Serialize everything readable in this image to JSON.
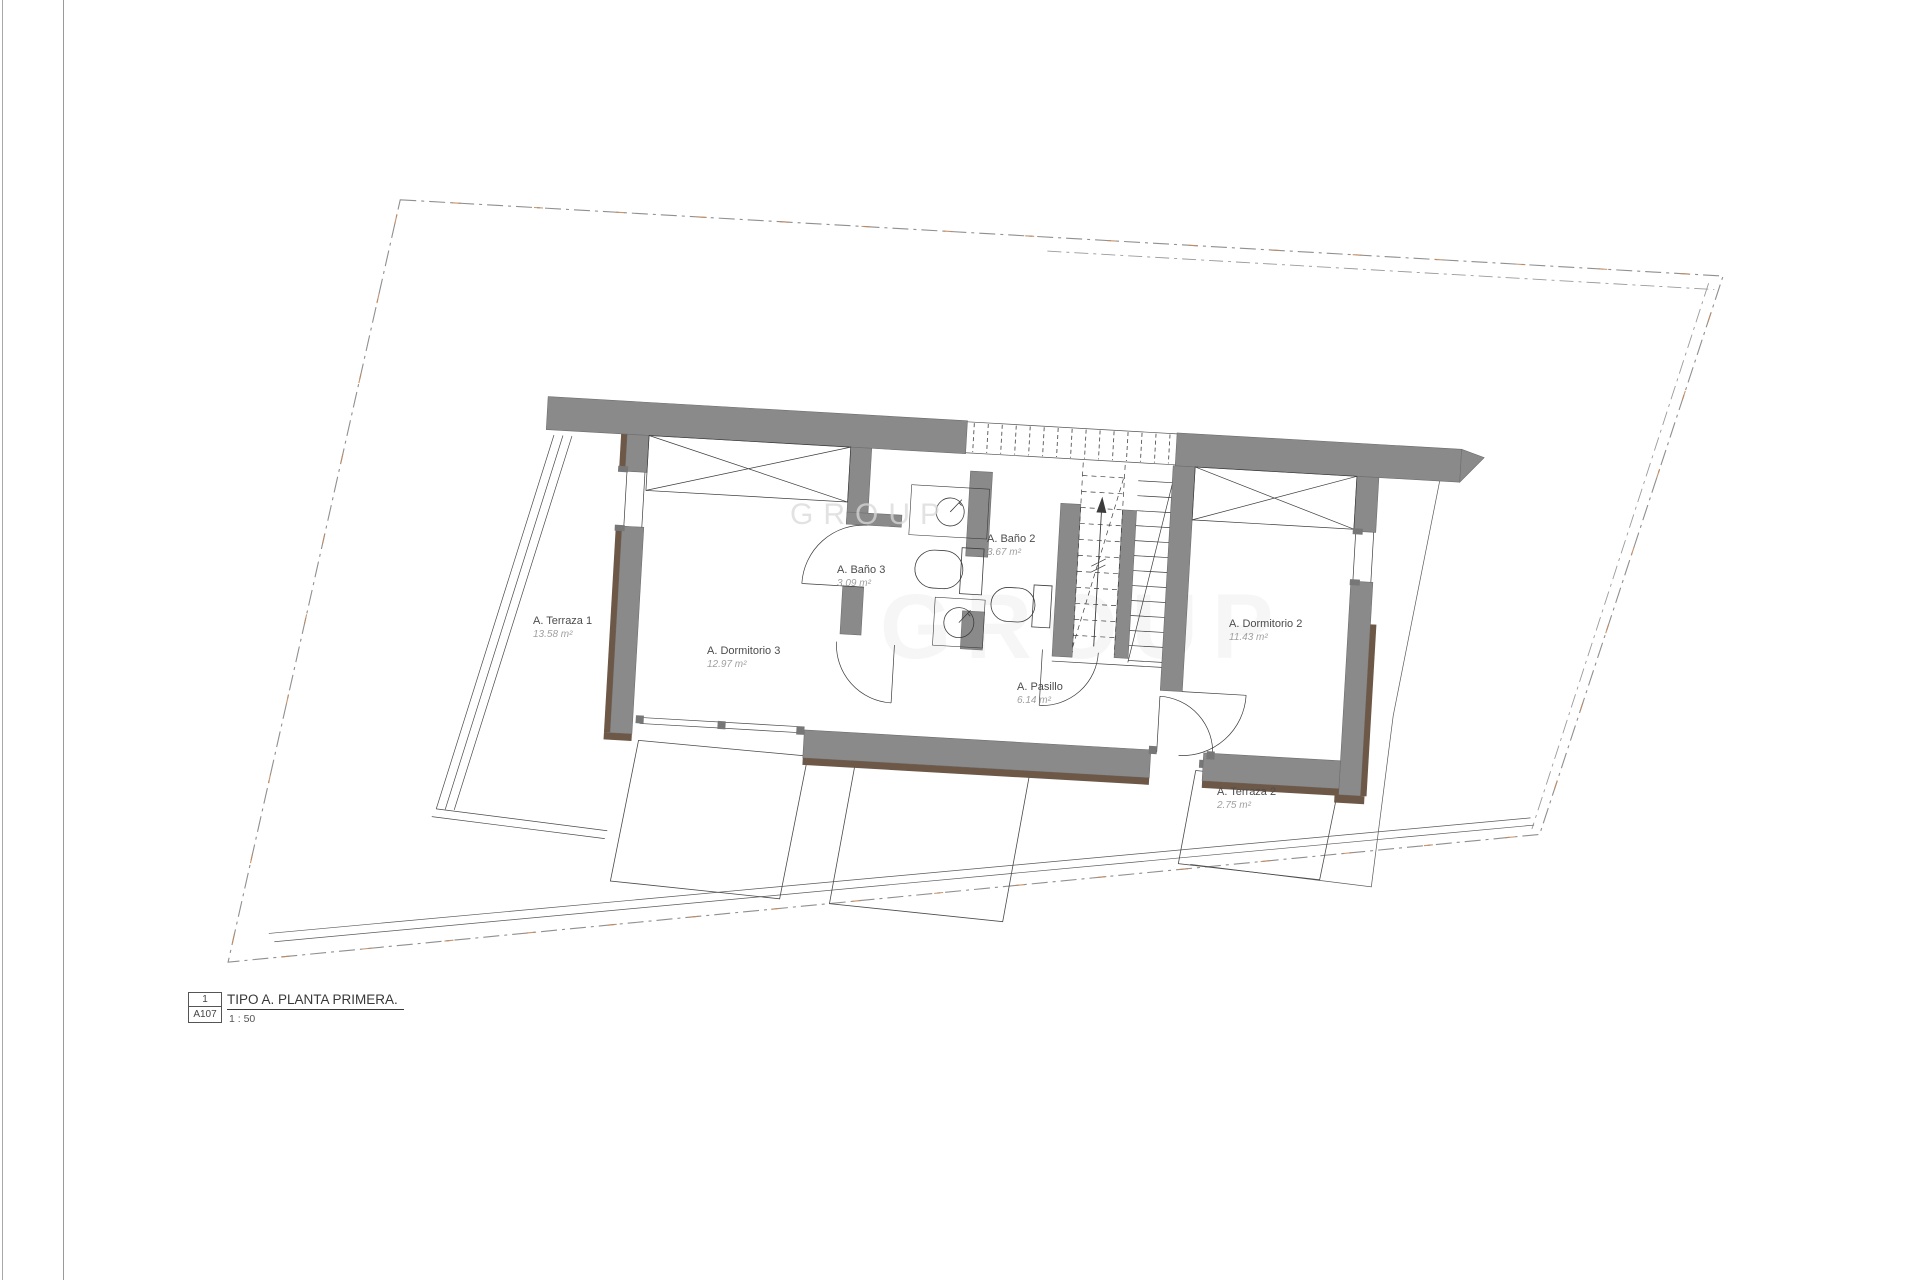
{
  "sheet": {
    "title_block": {
      "detail_number": "1",
      "sheet_ref": "A107",
      "title": "TIPO A. PLANTA PRIMERA.",
      "scale": "1 : 50"
    }
  },
  "plan": {
    "rooms": [
      {
        "name": "A. Terraza 1",
        "area": "13.58 m²"
      },
      {
        "name": "A. Dormitorio 3",
        "area": "12.97 m²"
      },
      {
        "name": "A. Baño 3",
        "area": "3.09 m²"
      },
      {
        "name": "A. Baño 2",
        "area": "3.67 m²"
      },
      {
        "name": "A. Pasillo",
        "area": "6.14 m²"
      },
      {
        "name": "A. Dormitorio 2",
        "area": "11.43 m²"
      },
      {
        "name": "A. Terraza 2",
        "area": "2.75 m²"
      }
    ],
    "watermark": {
      "text": "GROUP"
    },
    "colors": {
      "wall": "#8a8a8a",
      "wood_trim": "#6d5848",
      "line": "#3c3c3c",
      "boundary": "#8f8f8f",
      "boundary_accent": "#c08a5f"
    }
  }
}
